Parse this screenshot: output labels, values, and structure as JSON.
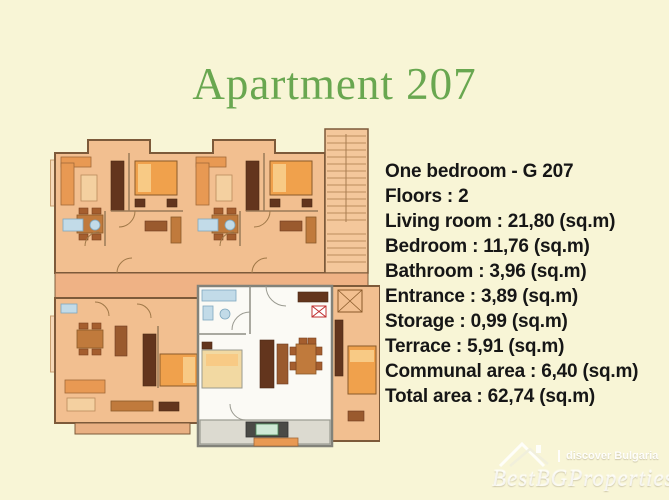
{
  "page": {
    "background_color": "#f8f5d6"
  },
  "title": {
    "text": "Apartment 207",
    "color": "#69a750"
  },
  "details": {
    "lines": [
      "One bedroom - G 207",
      "Floors : 2",
      "Living room : 21,80 (sq.m)",
      "Bedroom : 11,76 (sq.m)",
      "Bathroom : 3,96 (sq.m)",
      "Entrance : 3,89 (sq.m)",
      "Storage : 0,99 (sq.m)",
      "Terrace : 5,91 (sq.m)",
      "Communal area : 6,40 (sq.m)",
      "Total area : 62,74 (sq.m)"
    ]
  },
  "floorplan": {
    "type": "building-floor-plan",
    "highlighted_unit": "G 207",
    "elements": [
      "top-apartment-left",
      "top-apartment-right",
      "staircase",
      "corridor",
      "bottom-apartment-left",
      "apartment-207-highlighted",
      "bottom-apartment-right",
      "elevator",
      "terraces"
    ],
    "colors": {
      "plan_base": "#f2bf90",
      "highlight_unit": "#fbfaf5",
      "furniture_dark": "#63351d",
      "bed_orange": "#f0a14c",
      "bathroom_blue": "#c2dbe8",
      "terrace_gray": "#dcdad0",
      "wall_brown": "#7d5a3a"
    }
  },
  "watermark": {
    "tagline": "discover Bulgaria",
    "brand": "BestBGProperties",
    "color": "#ffffff"
  }
}
